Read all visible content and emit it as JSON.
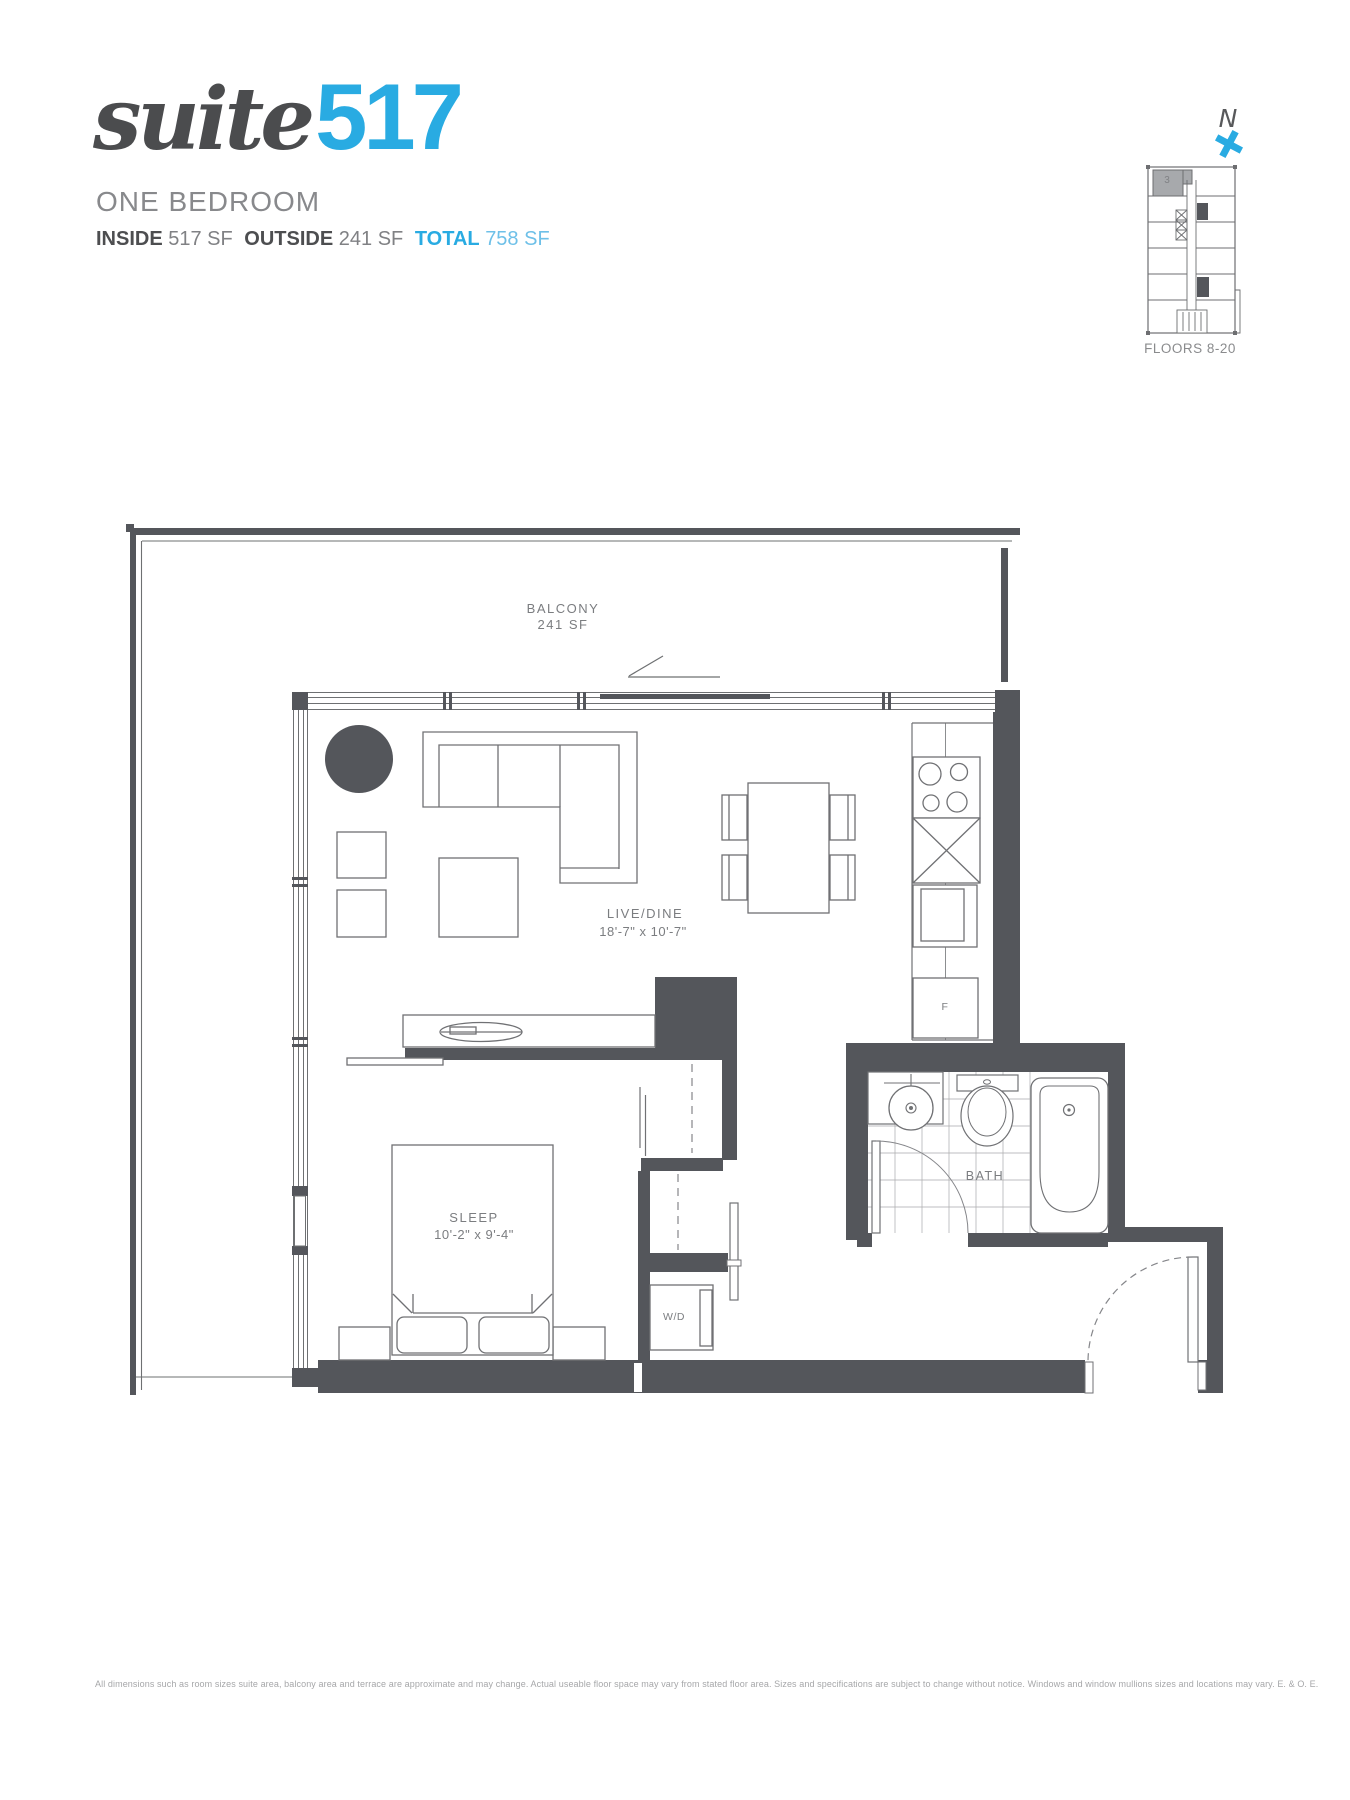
{
  "header": {
    "logo_script": "suite",
    "logo_number": "517",
    "subtitle": "ONE BEDROOM",
    "inside_label": "INSIDE",
    "inside_value": "517 SF",
    "outside_label": "OUTSIDE",
    "outside_value": "241 SF",
    "total_label": "TOTAL",
    "total_value": "758 SF",
    "accent_blue": "#29abe2",
    "dark_gray": "#4b4c4e"
  },
  "keyplan": {
    "north_label": "N",
    "unit_label": "3",
    "floors_label": "FLOORS 8-20"
  },
  "plan": {
    "balcony_name": "BALCONY",
    "balcony_area": "241 SF",
    "live_dine_name": "LIVE/DINE",
    "live_dine_dims": "18'-7\" x 10'-7\"",
    "sleep_name": "SLEEP",
    "sleep_dims": "10'-2\" x 9'-4\"",
    "bath_name": "BATH",
    "washer_dryer_label": "W/D",
    "fridge_label": "F",
    "wall_color": "#54565b"
  },
  "footer": {
    "disclaimer": "All dimensions such as room sizes suite area, balcony area and terrace are approximate and may change. Actual useable floor space may vary from stated floor area. Sizes and specifications are subject to change without notice. Windows and window mullions sizes and locations may vary. E. & O. E."
  }
}
